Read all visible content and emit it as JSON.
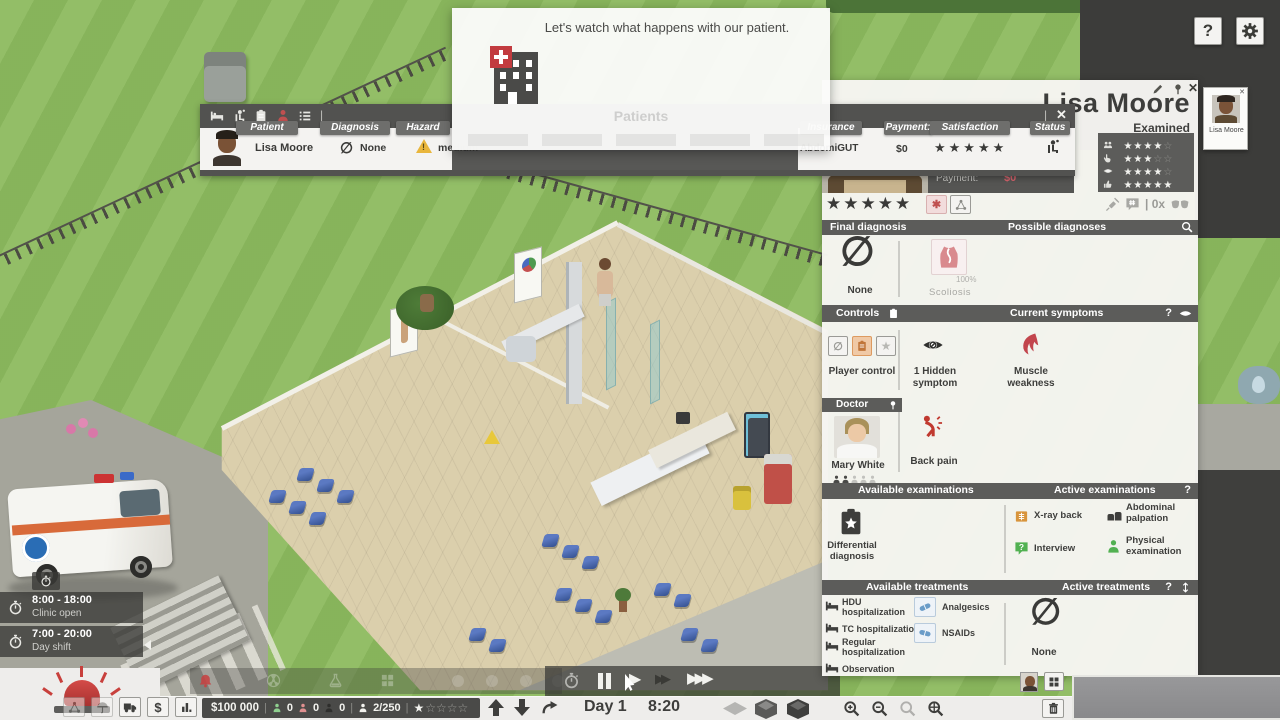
{
  "glyphs": {
    "none": "∅",
    "close": "✕",
    "help": "?",
    "pipe": "|",
    "bang": "!",
    "dollar": "$",
    "play": "▶",
    "ff": "▶▶",
    "fff": "▶▶▶"
  },
  "tutorial": {
    "message": "Let's watch what happens with our patient.",
    "ghost_title": "Patients"
  },
  "shift_info": {
    "rows": [
      {
        "time": "8:00 - 18:00",
        "label": "Clinic open"
      },
      {
        "time": "7:00 - 20:00",
        "label": "Day shift"
      }
    ]
  },
  "patient_list": {
    "header_columns": {
      "patient": "Patient",
      "diagnosis": "Diagnosis",
      "hazard": "Hazard",
      "insurance": "Insurance",
      "payment": "Payment:",
      "satisfaction": "Satisfaction",
      "status": "Status"
    },
    "row": {
      "name": "Lisa Moore",
      "diagnosis": "None",
      "hazard": "medium",
      "insurance": "AbdomiGUT",
      "payment": "$0",
      "stars": "★★★★★"
    }
  },
  "patient_detail": {
    "name": "Lisa Moore",
    "state": "Examined",
    "ratings": [
      {
        "filled": "★★★★",
        "empty": "☆"
      },
      {
        "filled": "★★★",
        "empty": "☆☆"
      },
      {
        "filled": "★★★★",
        "empty": "☆"
      },
      {
        "filled": "★★★★★",
        "empty": ""
      }
    ],
    "payment_label": "Payment:",
    "payment_value": "$0",
    "stars": "★★★★★",
    "objection_count": "| 0x",
    "sections": {
      "final_diagnosis": {
        "title": "Final diagnosis",
        "value": "None"
      },
      "possible_diagnoses": {
        "title": "Possible diagnoses",
        "item": "Scoliosis",
        "probability": "100%"
      },
      "controls": {
        "title": "Controls",
        "value": "Player control"
      },
      "symptoms": {
        "title": "Current symptoms",
        "hidden": "1 Hidden symptom",
        "items": [
          "Muscle weakness"
        ]
      },
      "doctor": {
        "title": "Doctor",
        "name": "Mary White",
        "complaint": "Back pain"
      },
      "avail_exams": {
        "title": "Available examinations",
        "items": [
          "Differential diagnosis"
        ]
      },
      "active_exams": {
        "title": "Active examinations",
        "items": [
          "X-ray back",
          "Abdominal palpation",
          "Interview",
          "Physical examination"
        ]
      },
      "avail_treatments": {
        "title": "Available treatments",
        "items": [
          "HDU hospitalization",
          "TC hospitalization",
          "Regular hospitalization",
          "Observation"
        ],
        "medications": [
          "Analgesics",
          "NSAIDs"
        ]
      },
      "active_treatments": {
        "title": "Active treatments",
        "value": "None"
      }
    }
  },
  "portrait_card": {
    "name": "Lisa Moore"
  },
  "time_controls": {
    "day": "Day 1",
    "time": "8:20"
  },
  "status_bar": {
    "money": "$100 000",
    "count_healthy": "0",
    "count_sick": "0",
    "count_other": "0",
    "capacity": "2/250",
    "stars_filled": "★",
    "stars_empty": "☆☆☆☆"
  }
}
